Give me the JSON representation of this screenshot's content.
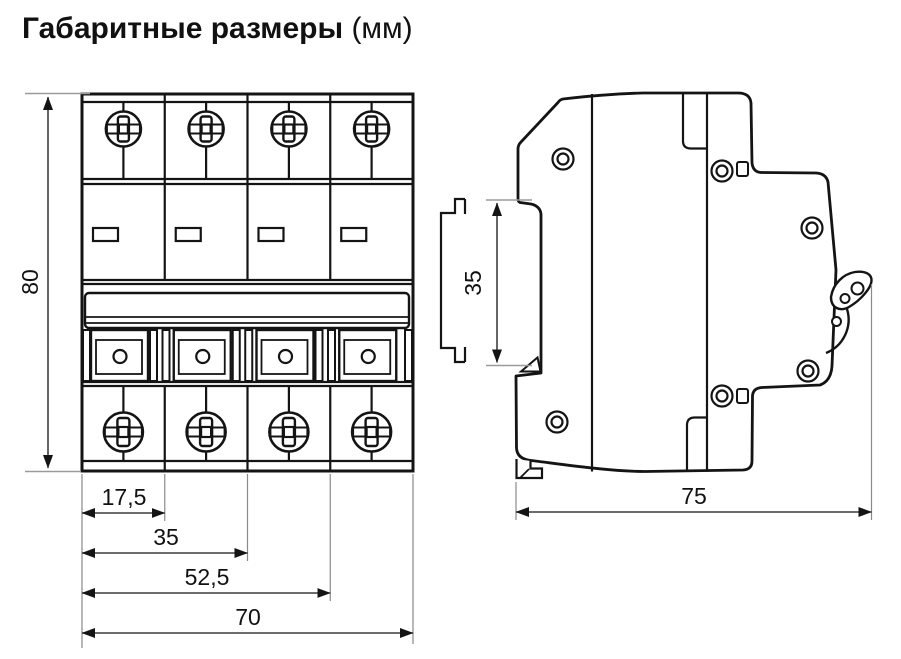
{
  "title": {
    "main": "Габаритные размеры",
    "unit": "(мм)"
  },
  "front_view": {
    "height_dim": "80",
    "width_dims": [
      "17,5",
      "35",
      "52,5",
      "70"
    ]
  },
  "side_view": {
    "rail_dim": "35",
    "depth_dim": "75"
  }
}
